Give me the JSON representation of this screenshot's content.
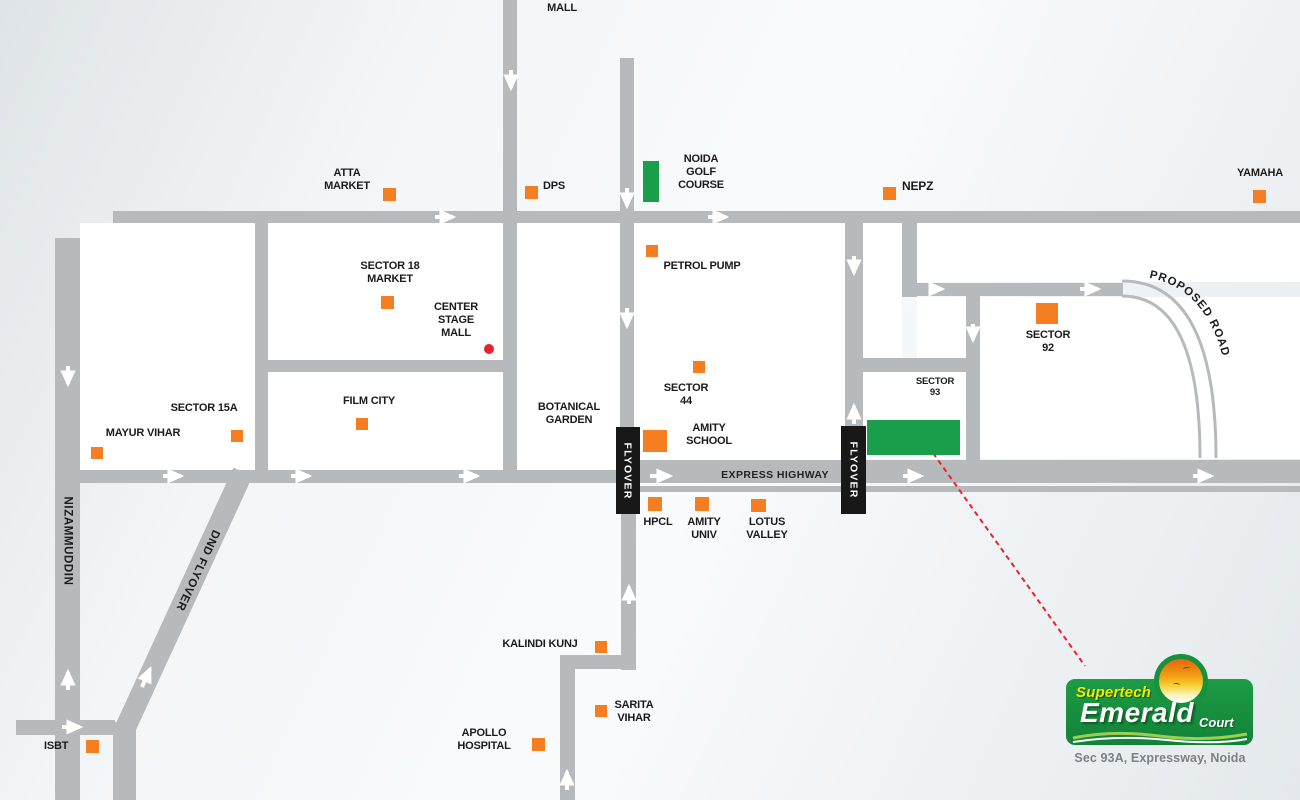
{
  "map": {
    "colors": {
      "road": "#b7babc",
      "block": "#ffffff",
      "marker_orange": "#f57f20",
      "landmark_green": "#1a9e4b",
      "flyover_sign_bg": "#181818",
      "flyover_sign_text": "#ffffff",
      "label_text": "#1b1b1b",
      "route_line_red": "#ee1f27",
      "red_dot": "#e8212e"
    },
    "flyover_label": "FLYOVER",
    "express_label": "EXPRESS HIGHWAY",
    "proposed_label": "PROPOSED ROAD",
    "places": [
      {
        "id": "shoppria-mall",
        "text": "SHOPPRIA\nMALL",
        "cx": 562,
        "top": -11
      },
      {
        "id": "atta-market",
        "text": "ATTA\nMARKET",
        "cx": 347,
        "top": 167,
        "marker": {
          "t": "sq",
          "x": 383,
          "y": 188,
          "w": 13,
          "h": 13
        }
      },
      {
        "id": "dps",
        "text": "DPS",
        "x": 543,
        "top": 180,
        "align": "left",
        "marker": {
          "t": "sq",
          "x": 525,
          "y": 186,
          "w": 13,
          "h": 13
        }
      },
      {
        "id": "noida-golf-course",
        "text": "NOIDA\nGOLF\nCOURSE",
        "cx": 701,
        "top": 153,
        "marker": {
          "t": "green",
          "x": 643,
          "y": 161,
          "w": 16,
          "h": 41
        }
      },
      {
        "id": "petrol-pump",
        "text": "PETROL PUMP",
        "cx": 702,
        "top": 260,
        "marker": {
          "t": "sq",
          "x": 646,
          "y": 245,
          "w": 12,
          "h": 12
        }
      },
      {
        "id": "nepz",
        "text": "NEPZ",
        "x": 902,
        "top": 180,
        "align": "left",
        "size": 12,
        "marker": {
          "t": "sq",
          "x": 883,
          "y": 187,
          "w": 13,
          "h": 13
        }
      },
      {
        "id": "yamaha",
        "text": "YAMAHA",
        "cx": 1260,
        "top": 167,
        "marker": {
          "t": "sq",
          "x": 1253,
          "y": 190,
          "w": 13,
          "h": 13
        }
      },
      {
        "id": "sector-18-market",
        "text": "SECTOR 18\nMARKET",
        "cx": 390,
        "top": 260,
        "marker": {
          "t": "sq",
          "x": 381,
          "y": 296,
          "w": 13,
          "h": 13
        }
      },
      {
        "id": "center-stage-mall",
        "text": "CENTER\nSTAGE\nMALL",
        "cx": 456,
        "top": 301,
        "marker": {
          "t": "dot",
          "x": 484,
          "y": 344,
          "w": 10,
          "h": 10
        }
      },
      {
        "id": "sector-92",
        "text": "SECTOR\n92",
        "cx": 1048,
        "top": 329,
        "marker": {
          "t": "sq",
          "x": 1036,
          "y": 303,
          "w": 22,
          "h": 21
        }
      },
      {
        "id": "sector-15a",
        "text": "SECTOR 15A",
        "cx": 204,
        "top": 402,
        "marker": {
          "t": "sq",
          "x": 231,
          "y": 430,
          "w": 12,
          "h": 12
        }
      },
      {
        "id": "mayur-vihar",
        "text": "MAYUR VIHAR",
        "cx": 143,
        "top": 427,
        "marker": {
          "t": "sq",
          "x": 91,
          "y": 447,
          "w": 12,
          "h": 12
        }
      },
      {
        "id": "film-city",
        "text": "FILM CITY",
        "cx": 369,
        "top": 395,
        "marker": {
          "t": "sq",
          "x": 356,
          "y": 418,
          "w": 12,
          "h": 12
        }
      },
      {
        "id": "botanical-garden",
        "text": "BOTANICAL\nGARDEN",
        "cx": 569,
        "top": 401
      },
      {
        "id": "sector-44",
        "text": "SECTOR\n44",
        "cx": 686,
        "top": 382,
        "marker": {
          "t": "sq",
          "x": 693,
          "y": 361,
          "w": 12,
          "h": 12
        }
      },
      {
        "id": "amity-school",
        "text": "AMITY\nSCHOOL",
        "cx": 709,
        "top": 422,
        "marker": {
          "t": "sq",
          "x": 643,
          "y": 430,
          "w": 24,
          "h": 22
        }
      },
      {
        "id": "sector-93",
        "text": "SECTOR\n93",
        "cx": 935,
        "top": 376,
        "size": 9.5,
        "marker": {
          "t": "green",
          "x": 867,
          "y": 420,
          "w": 93,
          "h": 35
        }
      },
      {
        "id": "hpcl",
        "text": "HPCL",
        "cx": 658,
        "top": 516,
        "marker": {
          "t": "sq",
          "x": 648,
          "y": 497,
          "w": 14,
          "h": 14
        }
      },
      {
        "id": "amity-univ",
        "text": "AMITY\nUNIV",
        "cx": 704,
        "top": 516,
        "marker": {
          "t": "sq",
          "x": 695,
          "y": 497,
          "w": 14,
          "h": 14
        }
      },
      {
        "id": "lotus-valley",
        "text": "LOTUS\nVALLEY",
        "cx": 767,
        "top": 516,
        "marker": {
          "t": "sq",
          "x": 751,
          "y": 499,
          "w": 15,
          "h": 13
        }
      },
      {
        "id": "isbt",
        "text": "ISBT",
        "x": 44,
        "top": 740,
        "align": "left",
        "marker": {
          "t": "sq",
          "x": 86,
          "y": 740,
          "w": 13,
          "h": 13
        }
      },
      {
        "id": "kalindi-kunj",
        "text": "KALINDI KUNJ",
        "cx": 540,
        "top": 638,
        "marker": {
          "t": "sq",
          "x": 595,
          "y": 641,
          "w": 12,
          "h": 12
        }
      },
      {
        "id": "sarita-vihar",
        "text": "SARITA\nVIHAR",
        "cx": 634,
        "top": 699,
        "marker": {
          "t": "sq",
          "x": 595,
          "y": 705,
          "w": 12,
          "h": 12
        }
      },
      {
        "id": "apollo-hospital",
        "text": "APOLLO\nHOSPITAL",
        "cx": 484,
        "top": 727,
        "marker": {
          "t": "sq",
          "x": 532,
          "y": 738,
          "w": 13,
          "h": 13
        }
      },
      {
        "id": "nizammuddin-road",
        "text": "NIZAMMUDDIN",
        "cx": 67,
        "cy": 541,
        "rot": 90,
        "size": 11.5
      },
      {
        "id": "dnd-flyover-road",
        "text": "DND FLYOVER",
        "cx": 197,
        "cy": 570,
        "rot": 115,
        "size": 11.5
      }
    ]
  },
  "logo": {
    "brand": "Supertech",
    "name": "Emerald",
    "suffix": "Court",
    "tagline": "Sec 93A, Expressway, Noida"
  }
}
